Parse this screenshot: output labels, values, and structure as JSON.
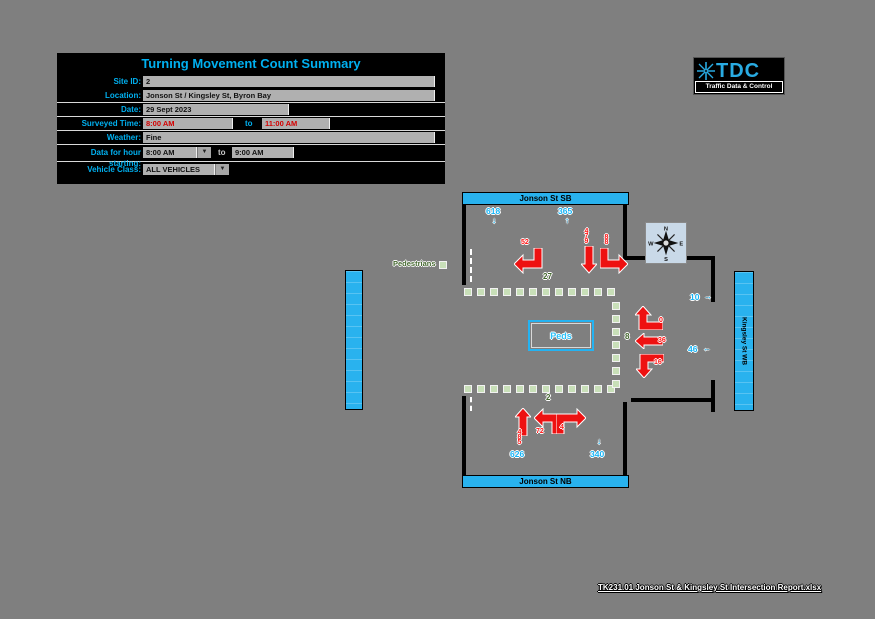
{
  "form": {
    "title": "Turning Movement Count Summary",
    "site_id": {
      "label": "Site ID:",
      "value": "2"
    },
    "location": {
      "label": "Location:",
      "value": "Jonson St / Kingsley St, Byron Bay"
    },
    "date": {
      "label": "Date:",
      "value": "29 Sept 2023"
    },
    "surveyed_time": {
      "label": "Surveyed Time:",
      "from": "8:00 AM",
      "to_word": "to",
      "to": "11:00 AM"
    },
    "weather": {
      "label": "Weather:",
      "value": "Fine"
    },
    "hour_starting": {
      "label": "Data for hour starting:",
      "value": "8:00 AM",
      "to_word": "to",
      "end": "9:00 AM"
    },
    "vehicle_class": {
      "label": "Vehicle Class:",
      "value": "ALL VEHICLES"
    }
  },
  "logo": {
    "acronym": "TDC",
    "tagline": "Traffic Data & Control"
  },
  "icons": {
    "dropdown_arrow": "▼",
    "down": "↓",
    "up": "↑",
    "left": "←",
    "right": "→"
  },
  "diagram": {
    "legend_pedestrians": "Pedestrians",
    "streets": {
      "north": "Jonson St SB",
      "south": "Jonson St NB",
      "east": "Kingsley St WB"
    },
    "compass": {
      "n": "N",
      "e": "E",
      "s": "S",
      "w": "W"
    },
    "peds_box_label": "Peds",
    "counts": {
      "southbound": {
        "inbound_total": "618",
        "outbound_total": "365",
        "turn_right": "52",
        "through": "479",
        "turn_left": "88"
      },
      "northbound": {
        "inbound_total": "626",
        "outbound_total": "340",
        "through": "485",
        "turn_left": "72",
        "turn_right": "4"
      },
      "westbound": {
        "turn_right": "0",
        "through": "36",
        "turn_left": "16",
        "side_top": "10",
        "side_bottom": "46"
      },
      "pedestrians": {
        "north_crossing": "27",
        "east_crossing": "8",
        "south_crossing": "2"
      }
    }
  },
  "footer": {
    "filename": "TK231.01 Jonson St & Kingsley St Intersection Report.xlsx"
  }
}
